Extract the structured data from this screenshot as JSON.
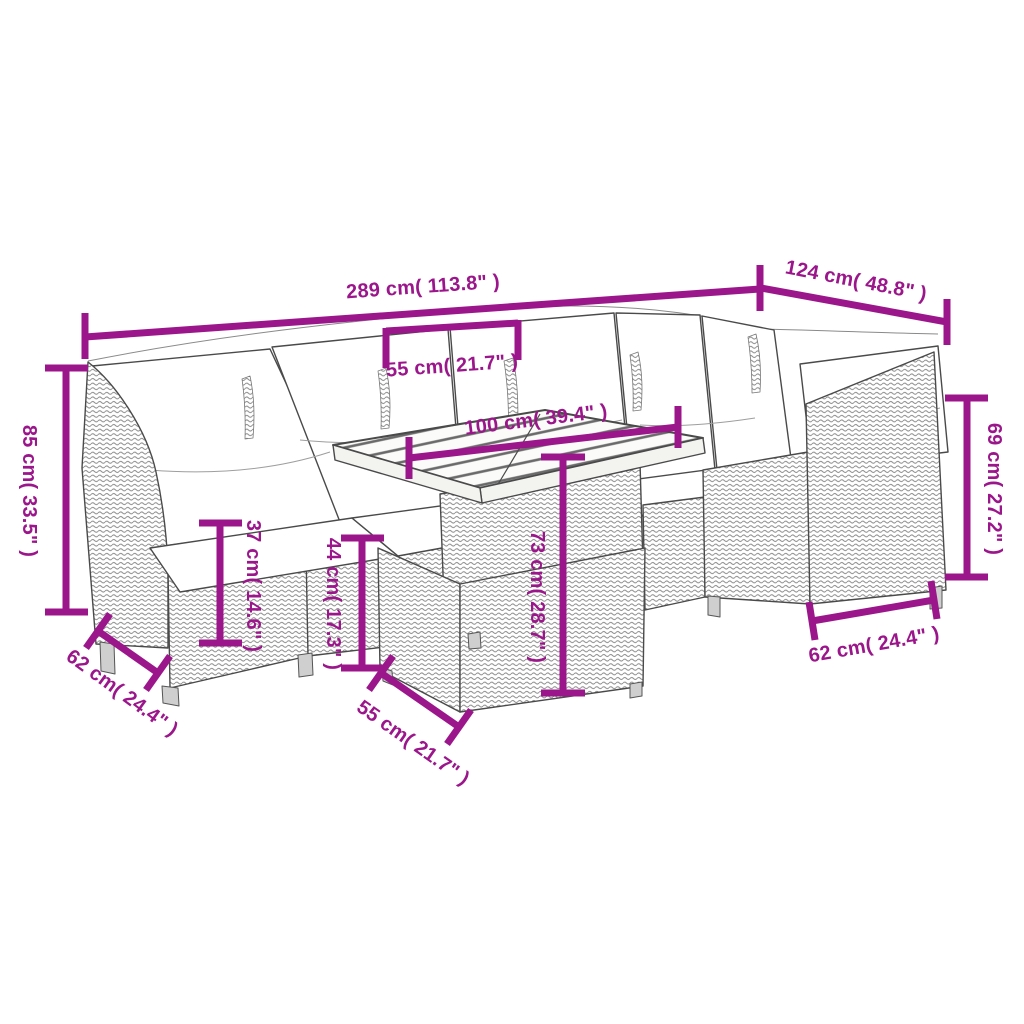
{
  "diagram": {
    "type": "product-dimension-diagram",
    "subject": "garden furniture lounge set with table and footstool"
  },
  "colors": {
    "dimension_accent": "#9b168b",
    "sketch_line": "#4a4a4a",
    "hatch": "#8d8d8d",
    "cushion": "#ffffff",
    "background": "#ffffff"
  },
  "dims": {
    "total_width": "289 cm( 113.8\" )",
    "total_depth": "124 cm( 48.8\" )",
    "back_height_left": "85 cm( 33.5\" )",
    "seat_depth_left": "62 cm( 24.4\" )",
    "seat_height": "37 cm( 14.6\" )",
    "footstool_height": "44 cm( 17.3\" )",
    "table_height": "73 cm( 28.7\" )",
    "table_length": "100 cm( 39.4\" )",
    "table_depth": "55 cm( 21.7\" )",
    "back_height_right": "69 cm( 27.2\" )",
    "seat_depth_right": "62 cm( 24.4\" )",
    "footstool_width": "55 cm( 21.7\" )"
  }
}
